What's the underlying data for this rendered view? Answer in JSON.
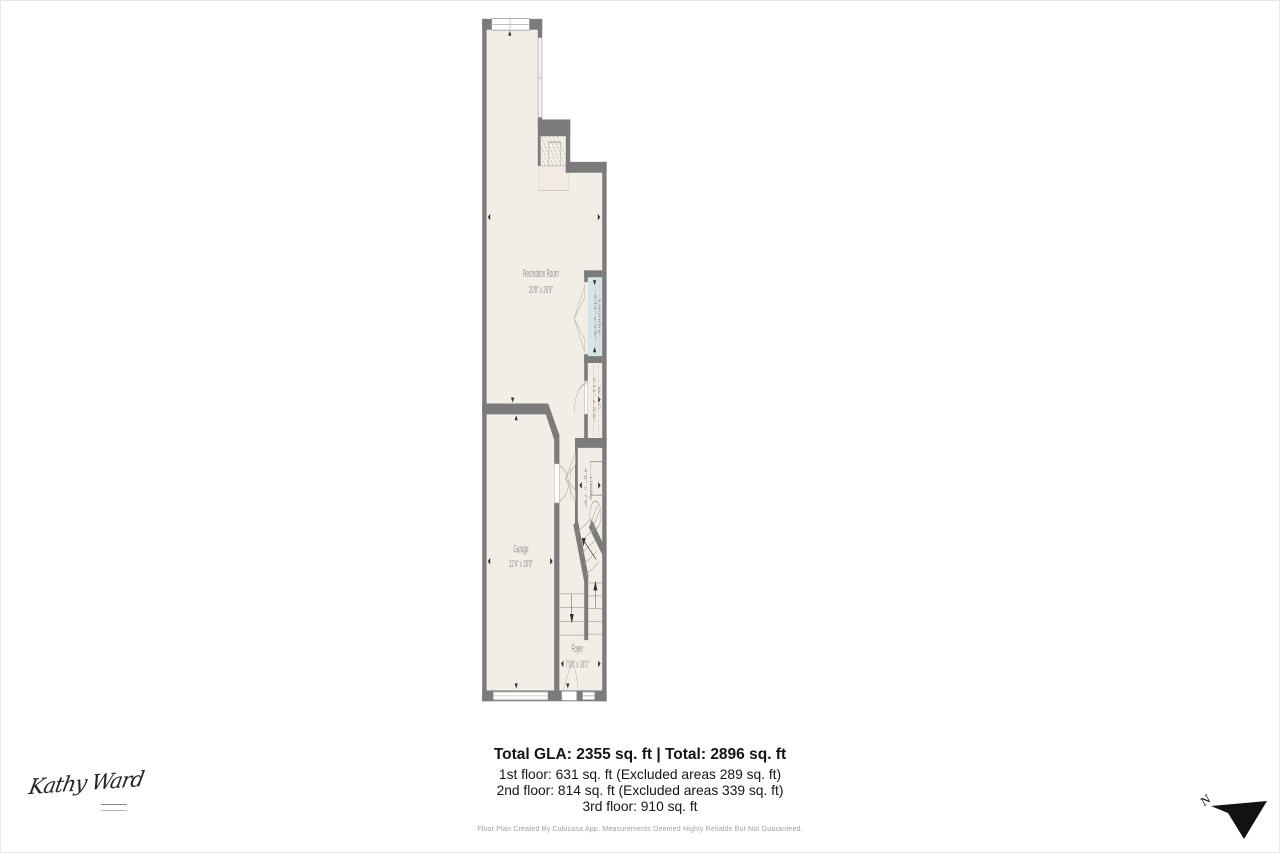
{
  "plan": {
    "rooms": {
      "recreation": {
        "name": "Recreation Room",
        "dims": "20'8\" x 26'9\""
      },
      "laundry": {
        "name": "Laundry",
        "dims": "2'11\" x 5'8\""
      },
      "wic": {
        "name": "W.I.C.",
        "dims": "2'11\" x 5'6\""
      },
      "utility": {
        "name": "Utility",
        "dims": "4'8\" x 7'8\""
      },
      "garage": {
        "name": "Garage",
        "dims": "12'4\" x 20'0\""
      },
      "foyer": {
        "name": "Foyer",
        "dims": "7'10\" x 18'1\""
      }
    },
    "colors": {
      "wall": "#7b7b7b",
      "floor": "#f3ede7",
      "laundry_floor": "#d8e5e7",
      "counter": "#f1ebe4",
      "label": "#8f8f8f",
      "tick": "#2f2f2f"
    }
  },
  "summary": {
    "title": "Total GLA: 2355 sq. ft | Total: 2896 sq. ft",
    "lines": [
      "1st floor: 631 sq. ft (Excluded areas 289 sq. ft)",
      "2nd floor: 814 sq. ft (Excluded areas 339 sq. ft)",
      "3rd floor: 910 sq. ft"
    ]
  },
  "footer": {
    "disclaimer": "Floor Plan Created By Cubicasa App. Measurements Deemed Highly Reliable But Not Guaranteed."
  },
  "branding": {
    "signature": "Kathy Ward"
  },
  "compass": {
    "label": "N"
  }
}
